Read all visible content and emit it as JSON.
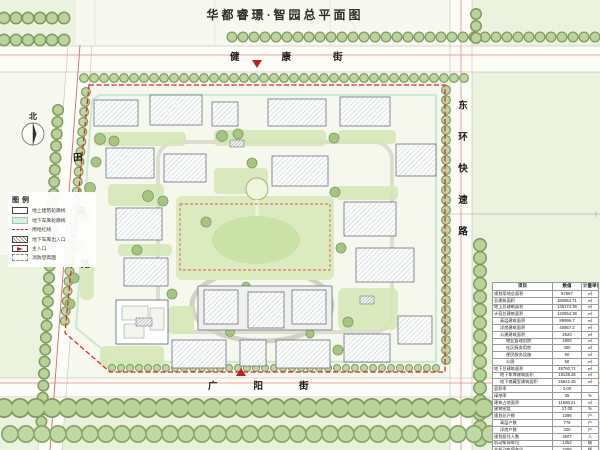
{
  "title": "华都睿璟·智园总平面图",
  "north": {
    "label": "北"
  },
  "streets": {
    "top": "健康街",
    "bottom": "广阳街",
    "left": "田安路",
    "right": "东环快速路"
  },
  "legend": {
    "title": "图例",
    "items": [
      {
        "label": "地上建筑轮廓线"
      },
      {
        "label": "地下车库轮廓线"
      },
      {
        "label": "用地红线"
      },
      {
        "label": "地下车库出入口"
      },
      {
        "label": "主入口"
      },
      {
        "label": "消防登高面"
      }
    ]
  },
  "site": {
    "kindergarten_label": "幼儿园"
  },
  "colors": {
    "boundary_red": "#e02020",
    "garage_green": "#cdebd4",
    "tree_green": "#b9d297",
    "road_pink": "#efa0a0"
  },
  "table": {
    "headers": [
      "项目",
      "数值",
      "计量单位"
    ],
    "rows": [
      {
        "label": "规划用地总面积",
        "value": "67567",
        "unit": "㎡",
        "indent": 0
      },
      {
        "label": "总建筑面积",
        "value": "180954.71",
        "unit": "㎡",
        "indent": 0
      },
      {
        "label": "地上总建筑面积",
        "value": "135174.38",
        "unit": "㎡",
        "indent": 0
      },
      {
        "label": "计容总建筑面积",
        "value": "132654.38",
        "unit": "㎡",
        "indent": 0
      },
      {
        "label": "高层建筑面积",
        "value": "89996.7",
        "unit": "㎡",
        "indent": 1
      },
      {
        "label": "洋房建筑面积",
        "value": "40967.3",
        "unit": "㎡",
        "indent": 1
      },
      {
        "label": "公建建筑面积",
        "value": "2520",
        "unit": "㎡",
        "indent": 1
      },
      {
        "label": "物业管理用房",
        "value": "1800",
        "unit": "㎡",
        "indent": 2
      },
      {
        "label": "社区服务用房",
        "value": "400",
        "unit": "㎡",
        "indent": 2
      },
      {
        "label": "便民服务设施",
        "value": "50",
        "unit": "㎡",
        "indent": 2
      },
      {
        "label": "公厕",
        "value": "50",
        "unit": "㎡",
        "indent": 2
      },
      {
        "label": "地下总建筑面积",
        "value": "45780.71",
        "unit": "㎡",
        "indent": 0
      },
      {
        "label": "地下车库建筑面积",
        "value": "19138.26",
        "unit": "㎡",
        "indent": 1
      },
      {
        "label": "地下储藏室建筑面积",
        "value": "26642.45",
        "unit": "㎡",
        "indent": 1
      },
      {
        "label": "容积率",
        "value": "2.00",
        "unit": "",
        "indent": 0
      },
      {
        "label": "绿地率",
        "value": "35",
        "unit": "%",
        "indent": 0
      },
      {
        "label": "建筑占地面积",
        "value": "11568.21",
        "unit": "㎡",
        "indent": 0
      },
      {
        "label": "建筑密度",
        "value": "17.00",
        "unit": "%",
        "indent": 0
      },
      {
        "label": "规划总户数",
        "value": "1096",
        "unit": "户",
        "indent": 0
      },
      {
        "label": "高层户数",
        "value": "776",
        "unit": "户",
        "indent": 1
      },
      {
        "label": "洋房户数",
        "value": "320",
        "unit": "户",
        "indent": 1
      },
      {
        "label": "规划居住人数",
        "value": "2507",
        "unit": "人",
        "indent": 0
      },
      {
        "label": "机动车停车位",
        "value": "1352",
        "unit": "辆",
        "indent": 0
      },
      {
        "label": "非机动车停车位",
        "value": "2366",
        "unit": "辆",
        "indent": 0
      }
    ]
  }
}
